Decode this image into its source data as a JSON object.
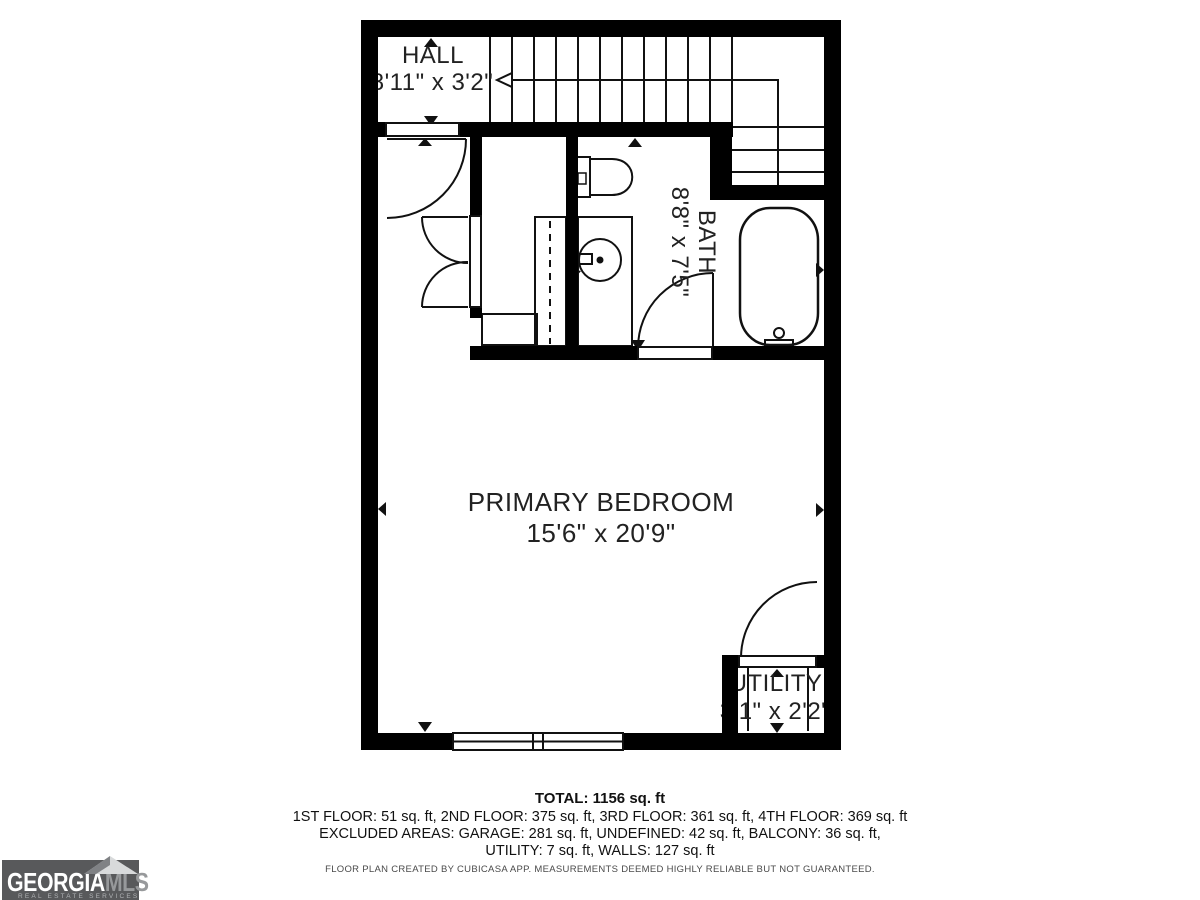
{
  "floor_plan": {
    "rooms": [
      {
        "id": "hall",
        "label": "HALL",
        "dimensions": "8'11\" x 3'2\""
      },
      {
        "id": "bath",
        "label": "BATH",
        "dimensions": "8'8\" x 7'5\""
      },
      {
        "id": "primary_bedroom",
        "label": "PRIMARY BEDROOM",
        "dimensions": "15'6\" x 20'9\""
      },
      {
        "id": "utility",
        "label": "UTILITY",
        "dimensions": "3'1\" x 2'2\""
      }
    ],
    "fixtures": [
      "stairs",
      "stair-direction-arrow",
      "toilet",
      "sink-vanity",
      "bathtub",
      "wardrobe-rail",
      "closet-shelf",
      "double-closet-doors",
      "door-swings",
      "window"
    ],
    "summary": {
      "total": "TOTAL: 1156 sq. ft",
      "floors": "1ST FLOOR: 51 sq. ft, 2ND FLOOR: 375 sq. ft, 3RD FLOOR: 361 sq. ft, 4TH FLOOR: 369 sq. ft",
      "excluded_line1": "EXCLUDED AREAS: GARAGE: 281 sq. ft, UNDEFINED: 42 sq. ft, BALCONY: 36 sq. ft,",
      "excluded_line2": "UTILITY: 7 sq. ft, WALLS: 127 sq. ft",
      "disclaimer": "FLOOR PLAN CREATED BY CUBICASA APP. MEASUREMENTS DEEMED HIGHLY RELIABLE BUT NOT GUARANTEED."
    },
    "logo": {
      "brand_primary": "GEORGIA",
      "brand_secondary": "MLS",
      "tagline": "REAL ESTATE SERVICES"
    },
    "colors": {
      "wall": "#000000",
      "line": "#111111",
      "logo_bg": "#58595b",
      "logo_secondary": "#97999b",
      "logo_roof_light": "#d8dadb",
      "logo_roof_dark": "#808285"
    }
  }
}
